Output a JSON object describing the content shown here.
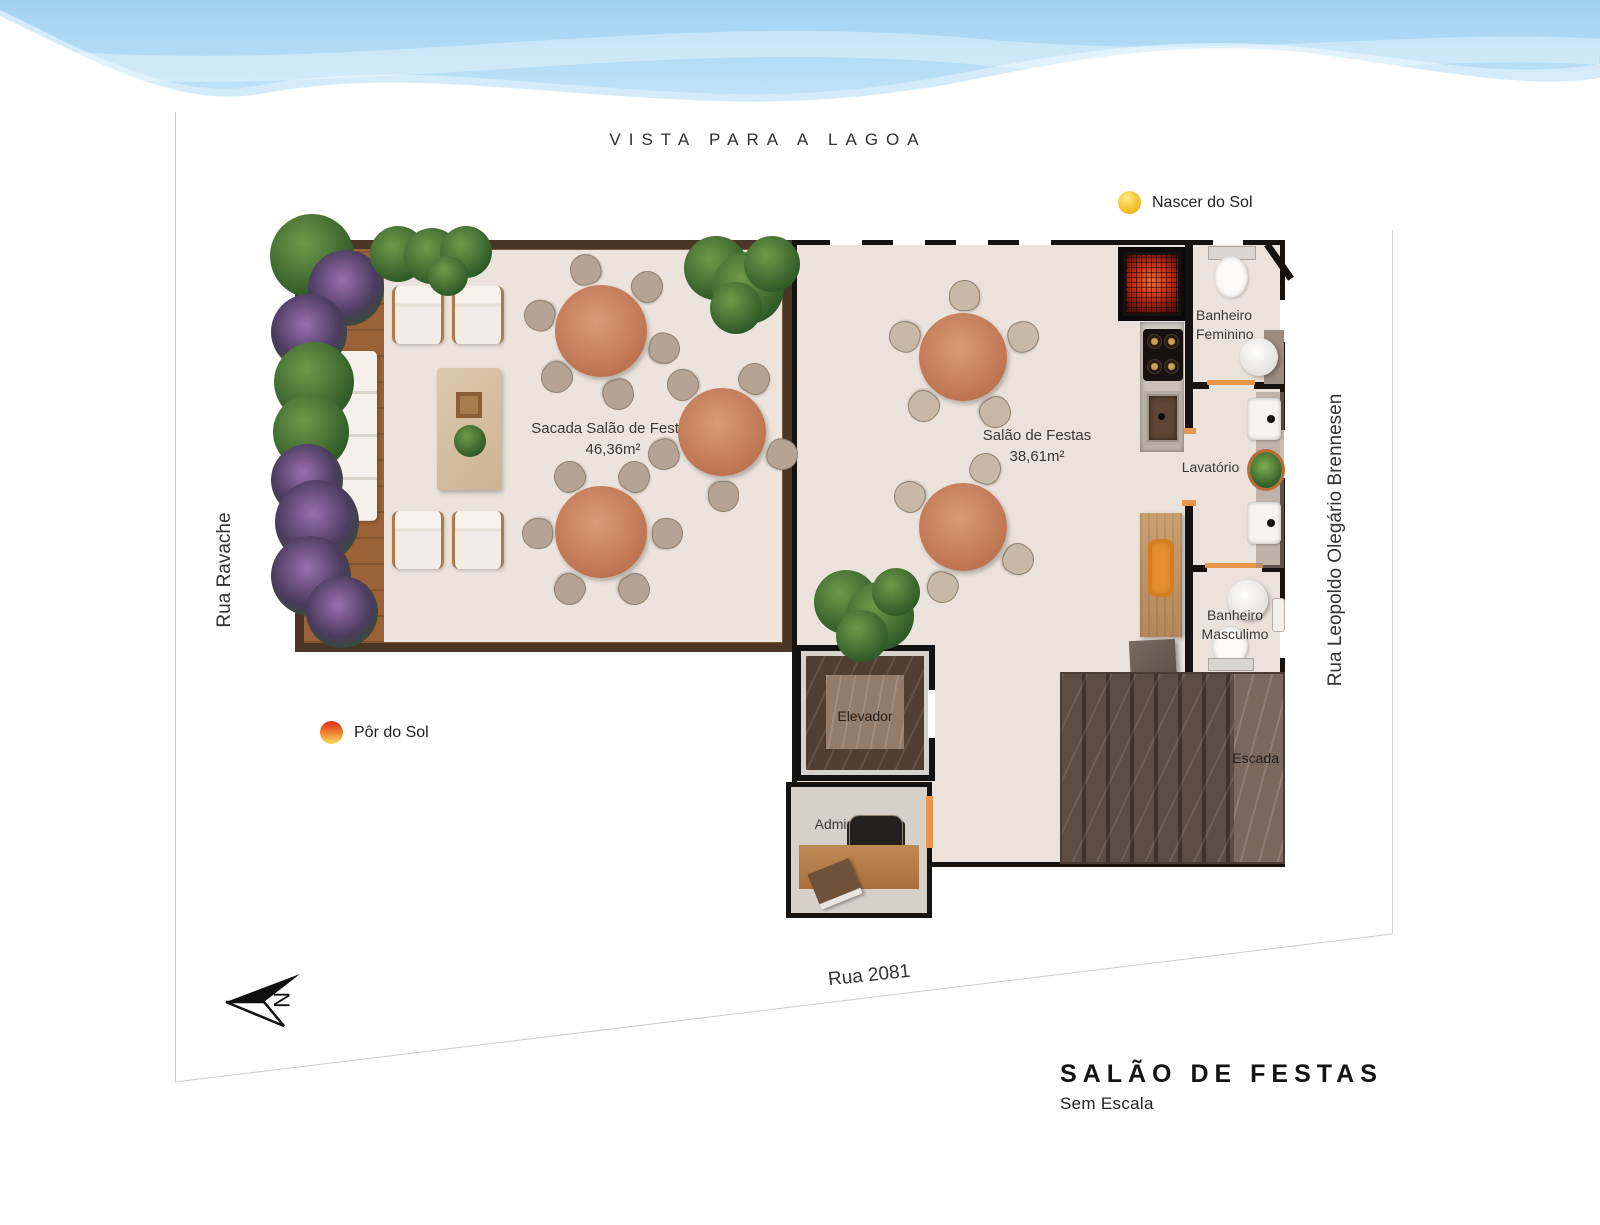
{
  "header": {
    "view_label": "VISTA PARA A LAGOA"
  },
  "legend": {
    "sunrise": "Nascer do Sol",
    "sunset": "Pôr do Sol"
  },
  "streets": {
    "left": "Rua Ravache",
    "right": "Rua Leopoldo Olegário Brennesen",
    "bottom": "Rua 2081"
  },
  "rooms": {
    "sacada_name": "Sacada Salão de Festas",
    "sacada_area": "46,36m²",
    "salao_name": "Salão de Festas",
    "salao_area": "38,61m²",
    "banheiro_feminino_l1": "Banheiro",
    "banheiro_feminino_l2": "Feminino",
    "lavatorio": "Lavatório",
    "banheiro_masculino_l1": "Banheiro",
    "banheiro_masculino_l2": "Masculimo",
    "elevador": "Elevador",
    "administracao": "Administração",
    "escada": "Escada"
  },
  "compass": {
    "north": "N"
  },
  "title_block": {
    "title": "SALÃO DE FESTAS",
    "subtitle": "Sem Escala"
  },
  "colors": {
    "sky_blue": "#a9d8f3",
    "sky_light": "#d3ebfa",
    "balcony_wall": "#4a3526",
    "interior_wall": "#151210",
    "floor": "#ece4dc",
    "door_accent": "#e8964a",
    "sun_yellow": "#f4bd24",
    "sunset_orange": "#e03a1c",
    "table_wood": "#bd7350",
    "stair_marble": "#4a3b33"
  }
}
